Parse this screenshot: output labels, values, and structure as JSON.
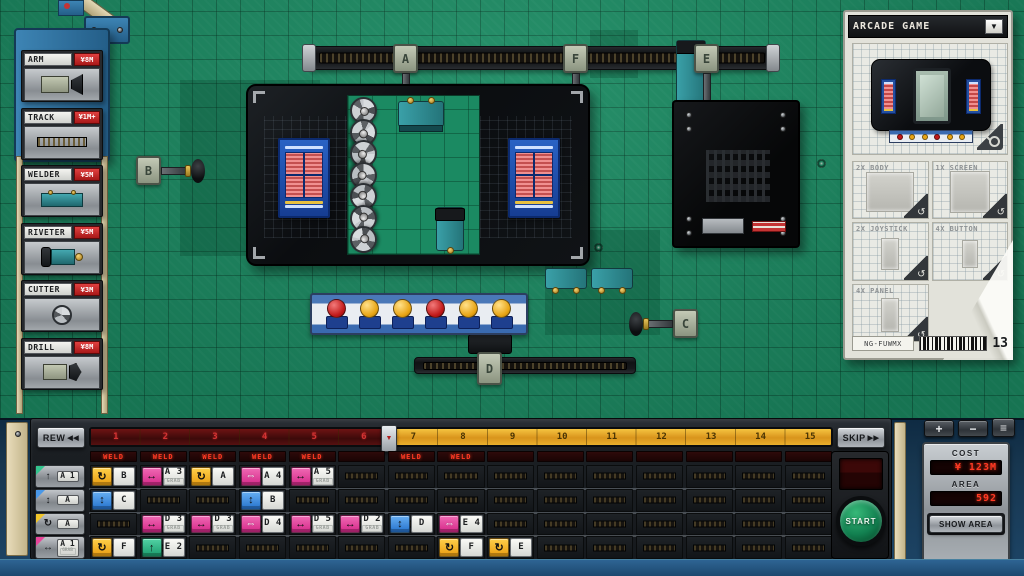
{
  "palette": {
    "items": [
      {
        "name": "ARM",
        "price": "¥8M",
        "art": "arm"
      },
      {
        "name": "TRACK",
        "price": "¥1M+",
        "art": "track"
      },
      {
        "name": "WELDER",
        "price": "¥5M",
        "art": "welder"
      },
      {
        "name": "RIVETER",
        "price": "¥5M",
        "art": "riveter"
      },
      {
        "name": "CUTTER",
        "price": "¥3M",
        "art": "cutter"
      },
      {
        "name": "DRILL",
        "price": "¥8M",
        "art": "drill"
      }
    ]
  },
  "product_panel": {
    "title": "ARCADE GAME",
    "dropdown_icon": "▼",
    "swap_icon": "↺",
    "parts": [
      "2X BODY",
      "1X SCREEN",
      "2X JOYSTICK",
      "4X BUTTON",
      "4X PANEL"
    ],
    "code": "NG-FUWMX",
    "count": "13"
  },
  "floor": {
    "node_labels": {
      "a": "A",
      "f": "F",
      "e": "E",
      "b": "B",
      "c": "C",
      "d": "D"
    },
    "button_panel_buttons": [
      "red",
      "yellow",
      "yellow",
      "red",
      "yellow",
      "yellow"
    ]
  },
  "transport": {
    "rew_label": "REW",
    "rew_icon": "◀◀",
    "skip_label": "SKIP",
    "skip_icon": "▶▶",
    "start_label": "START"
  },
  "timeline": {
    "ticks": [
      "1",
      "2",
      "3",
      "4",
      "5",
      "6",
      "7",
      "8",
      "9",
      "10",
      "11",
      "12",
      "13",
      "14",
      "15"
    ],
    "red_tick_count": 6,
    "playhead_icon": "▼"
  },
  "weld_row": {
    "label": "WELD",
    "lit_columns": [
      1,
      2,
      3,
      4,
      5,
      7,
      8
    ],
    "total_columns": 15
  },
  "program": {
    "cols": 15,
    "icon_glyphs": {
      "rotate": "↻",
      "grab": "↔",
      "move": "⇔",
      "vertical": "↕",
      "lift": "↑"
    },
    "icon_colors": {
      "rotate": "icon-yellow",
      "grab": "icon-pink",
      "move": "icon-pink",
      "vertical": "icon-blue",
      "lift": "icon-green"
    },
    "row_headers": [
      {
        "type": "lift",
        "corner": "#34c48e",
        "label": "A 1"
      },
      {
        "type": "vertical",
        "corner": "#4a98e8",
        "label": "A"
      },
      {
        "type": "rotate",
        "corner": "#f2c62a",
        "label": "A"
      },
      {
        "type": "grab",
        "corner": "#e8459a",
        "label": "A 1",
        "sub": "GRAB"
      }
    ],
    "blocks": [
      {
        "row": 1,
        "col": 1,
        "type": "rotate",
        "label": "B"
      },
      {
        "row": 1,
        "col": 2,
        "type": "grab",
        "label": "A 3",
        "sub": "GRAB"
      },
      {
        "row": 1,
        "col": 3,
        "type": "rotate",
        "label": "A"
      },
      {
        "row": 1,
        "col": 4,
        "type": "move",
        "label": "A 4"
      },
      {
        "row": 1,
        "col": 5,
        "type": "grab",
        "label": "A 5",
        "sub": "GRAB"
      },
      {
        "row": 2,
        "col": 1,
        "type": "vertical",
        "label": "C"
      },
      {
        "row": 2,
        "col": 4,
        "type": "vertical",
        "label": "B"
      },
      {
        "row": 3,
        "col": 2,
        "type": "grab",
        "label": "D 3",
        "sub": "GRAB"
      },
      {
        "row": 3,
        "col": 3,
        "type": "grab",
        "label": "D 3",
        "sub": "GRAB"
      },
      {
        "row": 3,
        "col": 4,
        "type": "move",
        "label": "D 4"
      },
      {
        "row": 3,
        "col": 5,
        "type": "grab",
        "label": "D 5",
        "sub": "GRAB"
      },
      {
        "row": 3,
        "col": 6,
        "type": "grab",
        "label": "D 2",
        "sub": "GRAB"
      },
      {
        "row": 3,
        "col": 7,
        "type": "vertical",
        "label": "D"
      },
      {
        "row": 3,
        "col": 8,
        "type": "move",
        "label": "E 4"
      },
      {
        "row": 4,
        "col": 1,
        "type": "rotate",
        "label": "F"
      },
      {
        "row": 4,
        "col": 2,
        "type": "lift",
        "label": "E 2"
      },
      {
        "row": 4,
        "col": 8,
        "type": "rotate",
        "label": "F"
      },
      {
        "row": 4,
        "col": 9,
        "type": "rotate",
        "label": "E"
      }
    ]
  },
  "cost_pod": {
    "plus_label": "+",
    "minus_label": "−",
    "menu_icon": "≡",
    "cost_label": "COST",
    "cost_value": "¥ 123M",
    "area_label": "AREA",
    "area_value": "592",
    "show_area_label": "SHOW AREA"
  }
}
